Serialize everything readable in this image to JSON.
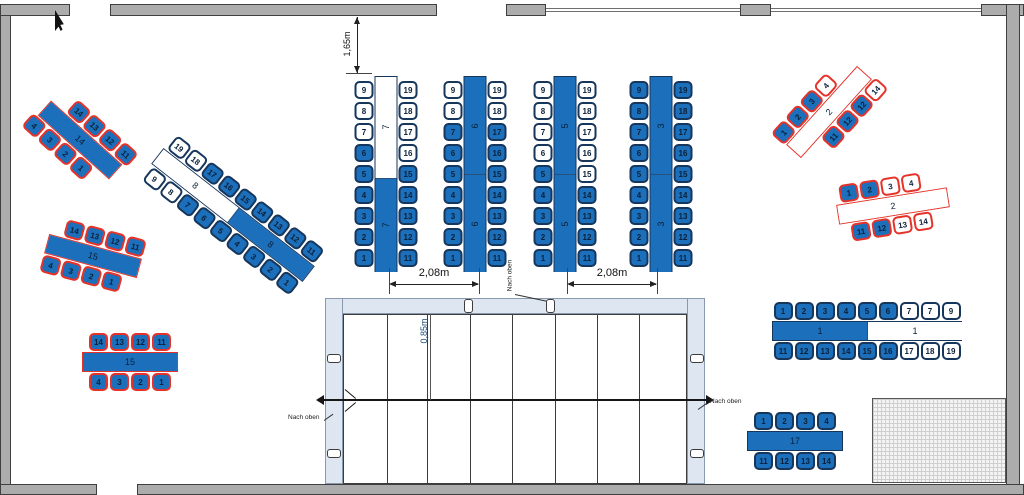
{
  "floorplan": {
    "colors": {
      "furniture_blue": "#1c6fba",
      "outline_dark": "#16365c",
      "outline_selected_red": "#e5332a",
      "wall_gray": "#acacac",
      "stair_wall_blue": "#dde6f1",
      "dim_text_blue": "#1f4e79"
    },
    "annotations": {
      "dim_top_vertical": "1,65m",
      "dim_row_gap_left": "2,08m",
      "dim_row_gap_right": "2,08m",
      "dim_stair_width": "0,85m",
      "nach_oben_left": "Nach oben",
      "nach_oben_center": "Nach oben",
      "nach_oben_right": "Nach oben"
    },
    "tables": [
      {
        "name": "table-14",
        "type": "h",
        "cx": 80,
        "cy": 140,
        "rot": 42,
        "tw": 96,
        "oc": "r",
        "segs": [
          {
            "l": "14",
            "f": "b"
          }
        ],
        "st": 12,
        "sb": -12,
        "top": [
          "14:b:r",
          "13:b:r",
          "12:b:r",
          "11:b:r"
        ],
        "bot": [
          "4:b:r",
          "3:b:r",
          "2:b:r",
          "1:b:r"
        ]
      },
      {
        "name": "table-15-upper",
        "type": "h",
        "cx": 93,
        "cy": 256,
        "rot": 15,
        "tw": 96,
        "oc": "r",
        "segs": [
          {
            "l": "15",
            "f": "b"
          }
        ],
        "st": 7,
        "sb": -7,
        "top": [
          "14:b:r",
          "13:b:r",
          "12:b:r",
          "11:b:r"
        ],
        "bot": [
          "4:b:r",
          "3:b:r",
          "2:b:r",
          "1:b:r"
        ]
      },
      {
        "name": "table-15-lower",
        "type": "h",
        "cx": 130,
        "cy": 362,
        "rot": 0,
        "tw": 96,
        "oc": "r",
        "segs": [
          {
            "l": "15",
            "f": "b"
          }
        ],
        "st": 0,
        "sb": 0,
        "top": [
          "14:b:r",
          "13:b:r",
          "12:b:r",
          "11:b:r"
        ],
        "bot": [
          "4:b:r",
          "3:b:r",
          "2:b:r",
          "1:b:r"
        ]
      },
      {
        "name": "table-8",
        "type": "h",
        "cx": 233,
        "cy": 215,
        "rot": 38,
        "tw": 192,
        "oc": "d",
        "segs": [
          {
            "l": "8",
            "f": "w"
          },
          {
            "l": "8",
            "f": "b"
          }
        ],
        "st": 0,
        "sb": 0,
        "top": [
          "19:w:d",
          "18:w:d",
          "17:b:d",
          "16:b:d",
          "15:b:d",
          "14:b:d",
          "13:b:d",
          "12:b:d",
          "11:b:d"
        ],
        "bot": [
          "9:w:d",
          "8:w:d",
          "7:b:d",
          "6:b:d",
          "5:b:d",
          "4:b:d",
          "3:b:d",
          "2:b:d",
          "1:b:d"
        ]
      },
      {
        "name": "table-7",
        "type": "v",
        "cx": 386,
        "cy": 174,
        "rot": 0,
        "oc": "d",
        "segs": [
          {
            "l": "7",
            "f": "w",
            "pct": 52
          },
          {
            "l": "7",
            "f": "b",
            "pct": 48
          }
        ],
        "left": [
          "9:w:d",
          "8:w:d",
          "7:w:d",
          "6:b:d",
          "5:b:d",
          "4:b:d",
          "3:b:d",
          "2:b:d",
          "1:b:d"
        ],
        "right": [
          "19:w:d",
          "18:w:d",
          "17:w:d",
          "16:w:d",
          "15:b:d",
          "14:b:d",
          "13:b:d",
          "12:b:d",
          "11:b:d"
        ]
      },
      {
        "name": "table-6",
        "type": "v",
        "cx": 475,
        "cy": 174,
        "rot": 0,
        "oc": "d",
        "segs": [
          {
            "l": "6",
            "f": "b",
            "pct": 50
          },
          {
            "l": "6",
            "f": "b",
            "pct": 50
          }
        ],
        "left": [
          "9:w:d",
          "8:w:d",
          "7:b:d",
          "6:b:d",
          "5:b:d",
          "4:b:d",
          "3:b:d",
          "2:b:d",
          "1:b:d"
        ],
        "right": [
          "19:w:d",
          "18:w:d",
          "17:b:d",
          "16:b:d",
          "15:b:d",
          "14:b:d",
          "13:b:d",
          "12:b:d",
          "11:b:d"
        ]
      },
      {
        "name": "table-5",
        "type": "v",
        "cx": 565,
        "cy": 174,
        "rot": 0,
        "oc": "d",
        "segs": [
          {
            "l": "5",
            "f": "b",
            "pct": 50
          },
          {
            "l": "5",
            "f": "b",
            "pct": 50
          }
        ],
        "left": [
          "9:w:d",
          "8:w:d",
          "7:w:d",
          "6:w:d",
          "5:b:d",
          "4:b:d",
          "3:b:d",
          "2:b:d",
          "1:b:d"
        ],
        "right": [
          "19:w:d",
          "18:w:d",
          "17:w:d",
          "16:w:d",
          "15:w:d",
          "14:b:d",
          "13:b:d",
          "12:b:d",
          "11:b:d"
        ]
      },
      {
        "name": "table-3",
        "type": "v",
        "cx": 661,
        "cy": 174,
        "rot": 0,
        "oc": "d",
        "segs": [
          {
            "l": "3",
            "f": "b",
            "pct": 50
          },
          {
            "l": "3",
            "f": "b",
            "pct": 50
          }
        ],
        "left": [
          "9:b:d",
          "8:b:d",
          "7:b:d",
          "6:b:d",
          "5:b:d",
          "4:b:d",
          "3:b:d",
          "2:b:d",
          "1:b:d"
        ],
        "right": [
          "19:b:d",
          "18:b:d",
          "17:b:d",
          "16:b:d",
          "15:b:d",
          "14:b:d",
          "13:b:d",
          "12:b:d",
          "11:b:d"
        ]
      },
      {
        "name": "table-2-upper",
        "type": "h",
        "cx": 829,
        "cy": 112,
        "rot": -48,
        "tw": 106,
        "oc": "r",
        "segs": [
          {
            "l": "2",
            "f": "w"
          }
        ],
        "st": -14,
        "sb": 16,
        "top": [
          "1:b:r",
          "2:b:r",
          "3:b:r",
          "4:w:r"
        ],
        "bot": [
          "11:b:r",
          "12:b:r",
          "12:b:r",
          "14:w:r"
        ]
      },
      {
        "name": "table-2-lower",
        "type": "h",
        "cx": 893,
        "cy": 206,
        "rot": -9,
        "tw": 112,
        "oc": "r",
        "segs": [
          {
            "l": "2",
            "f": "w"
          }
        ],
        "st": -10,
        "sb": -4,
        "top": [
          "1:b:r",
          "2:b:r",
          "3:w:r",
          "4:w:r"
        ],
        "bot": [
          "11:b:r",
          "12:b:r",
          "13:w:r",
          "14:w:r"
        ]
      },
      {
        "name": "table-1",
        "type": "h",
        "cx": 867,
        "cy": 331,
        "rot": 0,
        "tw": 190,
        "oc": "d",
        "segs": [
          {
            "l": "1",
            "f": "b",
            "pct": 50
          },
          {
            "l": "1",
            "f": "w",
            "pct": 50
          }
        ],
        "st": 0,
        "sb": 0,
        "top": [
          "1:b:d",
          "2:b:d",
          "3:b:d",
          "4:b:d",
          "5:b:d",
          "6:b:d",
          "7:w:d",
          "7:w:d",
          "9:w:d"
        ],
        "bot": [
          "11:b:d",
          "12:b:d",
          "13:b:d",
          "14:b:d",
          "15:b:d",
          "16:b:d",
          "17:w:d",
          "18:w:d",
          "19:w:d"
        ]
      },
      {
        "name": "table-17",
        "type": "h",
        "cx": 795,
        "cy": 441,
        "rot": 0,
        "tw": 96,
        "oc": "d",
        "segs": [
          {
            "l": "17",
            "f": "b"
          }
        ],
        "st": 0,
        "sb": 0,
        "top": [
          "1:b:d",
          "2:b:d",
          "3:b:d",
          "4:b:d"
        ],
        "bot": [
          "11:b:d",
          "12:b:d",
          "13:b:d",
          "14:b:d"
        ]
      }
    ],
    "stairs": {
      "step_lines_x": [
        387,
        427,
        470,
        512,
        555,
        597,
        639
      ]
    }
  }
}
